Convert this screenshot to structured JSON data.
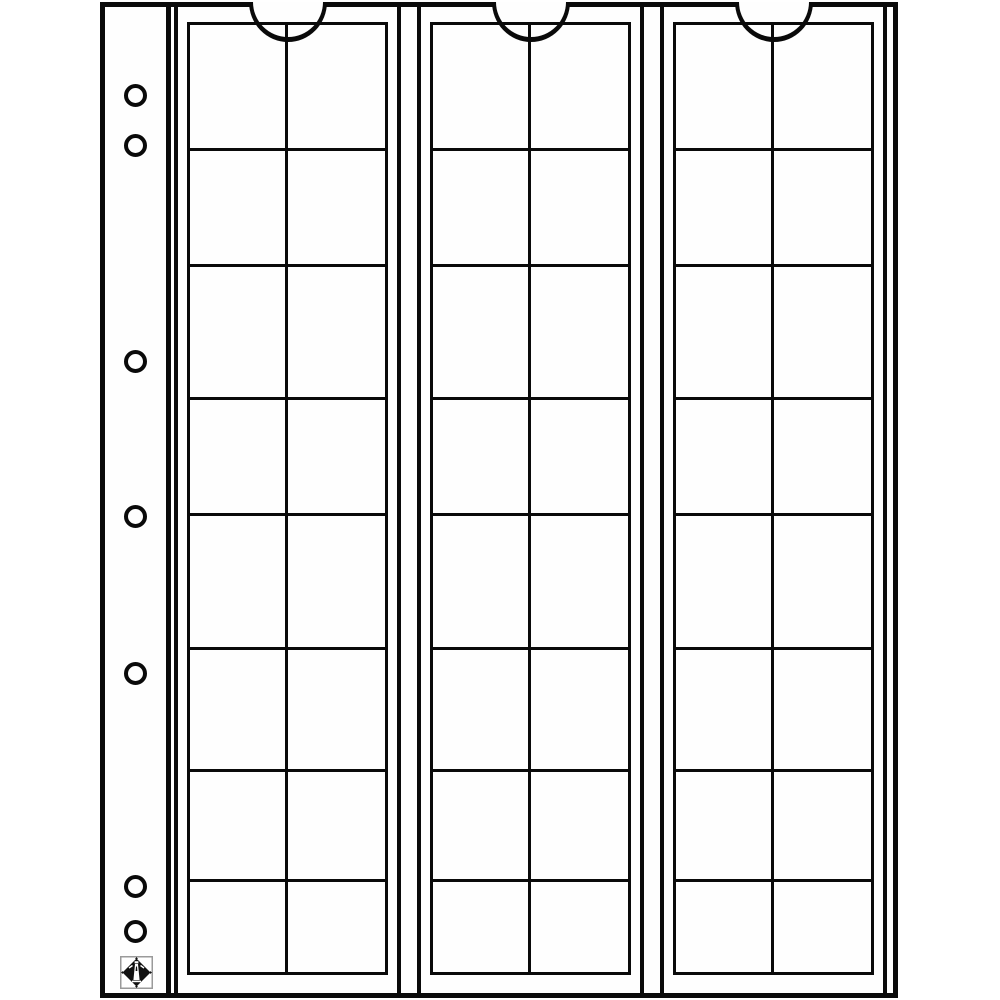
{
  "page": {
    "background_color": "#ffffff",
    "paper_color": "#fefefe",
    "ink_color": "#0a0a0a"
  },
  "binder_margin": {
    "hole_count": 7,
    "hole_centers_y": [
      95,
      145,
      361,
      516,
      673,
      886,
      931
    ],
    "logo_icon": "lighthouse-diamond"
  },
  "strips": [
    {
      "id": 1,
      "pocket_count": 16
    },
    {
      "id": 2,
      "pocket_count": 16
    },
    {
      "id": 3,
      "pocket_count": 16
    }
  ],
  "grid": {
    "rows": 8,
    "columns": 2,
    "total_pockets": 48
  },
  "strip_left_offsets": [
    69,
    312,
    555
  ]
}
